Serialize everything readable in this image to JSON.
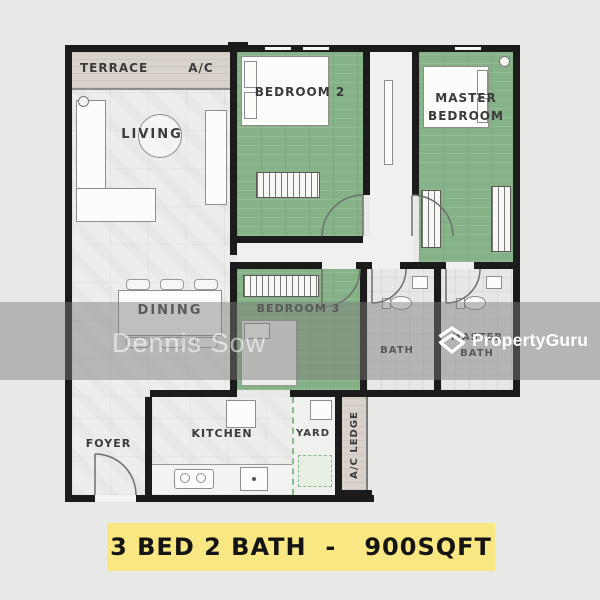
{
  "plan": {
    "rooms": {
      "terrace": "TERRACE",
      "ac_unit": "A/C",
      "living": "LIVING",
      "bedroom2": "BEDROOM 2",
      "master_bedroom_line1": "MASTER",
      "master_bedroom_line2": "BEDROOM",
      "dining": "DINING",
      "bedroom3": "BEDROOM 3",
      "bath": "BATH",
      "master_bath_line1": "MASTER",
      "master_bath_line2": "BATH",
      "foyer": "FOYER",
      "kitchen": "KITCHEN",
      "yard": "YARD",
      "ac_ledge": "A/C LEDGE"
    },
    "colors": {
      "wall": "#1b1b1b",
      "bedroom_floor_green": "#85b287",
      "common_floor_marble": "#ededeb",
      "terrace_beige": "#d8d2ca",
      "bath_tile": "#e7e7e5"
    }
  },
  "watermark": {
    "agent_name": "Dennis Sow",
    "brand": "PropertyGuru",
    "band_color": "#7c7c79"
  },
  "banner": {
    "text": "3 BED 2 BATH  -   900SQFT",
    "background": "#f9e784",
    "beds": "3",
    "baths": "2",
    "size_sqft": "900"
  }
}
